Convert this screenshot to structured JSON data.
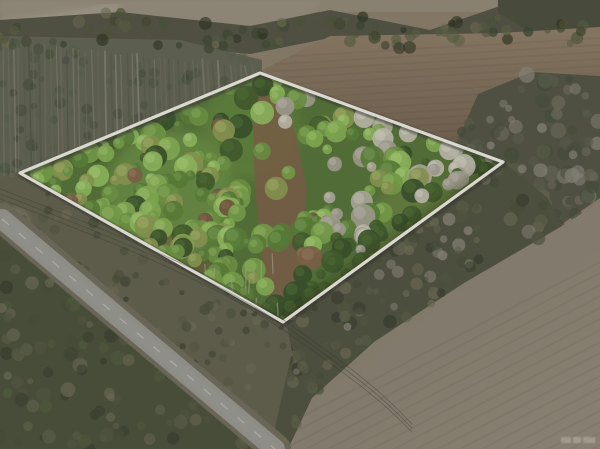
{
  "scene": {
    "type": "aerial-drone-photo",
    "subject": "wooded land parcel outlined with a white survey boundary",
    "surroundings": [
      "plowed brown fields",
      "pine tree lines",
      "rural paved road",
      "power lines along road"
    ],
    "boundary": {
      "color": "#f7f4ea",
      "shadow": "rgba(40,42,30,0.5)"
    },
    "watermark": {
      "present": true,
      "legible": false
    },
    "palette": {
      "base": "#8a7c66",
      "haze": "#978e7c",
      "haze_path": "#b0a795",
      "treeline": "#4b4b3b",
      "corner_clump": "#434534",
      "forest_base": "#5c5f4d",
      "forest_trunks": [
        "#8a8475",
        "#6f6a5b",
        "#4e4f3f"
      ],
      "forest_crowns": [
        "#475139",
        "#3a4430",
        "#525c42"
      ],
      "field_top_a": "#83705a",
      "field_top_b": "#6f5d49",
      "field_right": "#8b8372",
      "hedgerow_base": "#4b4d3a",
      "hedgerow_crowns": [
        "#3e4530",
        "#565a45",
        "#6e6b58",
        "#8c887a"
      ],
      "se_band_base": "#474a36",
      "sw_strip_base": "#5d5c46",
      "bottom_left_base": "#434830",
      "brush_crowns": [
        "#4d5138",
        "#3f452e",
        "#5a5d42",
        "#6b6a50",
        "#2f3423"
      ],
      "road_shoulder": "#6b6756",
      "road_asphalt": "#97968e",
      "road_tint": "#a09f97",
      "road_centerline": "#c6c5bb",
      "canopy_base": "#4e6f2e",
      "canopy_greens": [
        [
          "#86b44c",
          "#a5cf6d"
        ],
        [
          "#76a441",
          "#97c262"
        ],
        [
          "#93c258",
          "#b3da78"
        ],
        [
          "#6a9639",
          "#8cb858"
        ],
        [
          "#557f2e",
          "#76a24c"
        ],
        [
          "#8a9a4a",
          "#adbc68"
        ]
      ],
      "canopy_dark": [
        "#39571f",
        "#2f4a1e"
      ],
      "canopy_silver": [
        [
          "#c9c4b4",
          "#e0dccf"
        ],
        [
          "#b7b2a2",
          "#d2cec0"
        ],
        [
          "#a8a494",
          "#c4c0b2"
        ]
      ],
      "canopy_brown": [
        [
          "#7e5f41",
          "#9a7a58"
        ],
        [
          "#6e4f36",
          "#8a6a4a"
        ]
      ],
      "dirt_strip": "#7b5b3f",
      "dirt_red": "#7a4a30",
      "trunk_light": "#b5a88c",
      "wire": "#2e2e26",
      "row_shade": "rgba(50,42,30,0.07)",
      "watermark_ink": "rgba(228,223,208,0.30)"
    }
  }
}
